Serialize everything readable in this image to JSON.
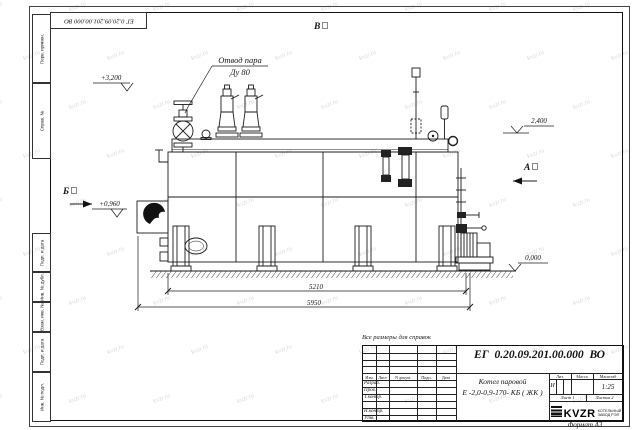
{
  "watermark": {
    "text": "kvzr.ru"
  },
  "stamps": {
    "top_designation": "ЕГ 0.20.09.201.00.000 ВО",
    "left_top": [
      "Перв. примен.",
      "Справ. №"
    ],
    "left_bottom": [
      "Подп. и дата",
      "Инв. № дубл.",
      "Взам. инв. №",
      "Подп. и дата",
      "Инв. № подл."
    ],
    "format_label": "Формат А3"
  },
  "annotations": {
    "note": "Все размеры для справок",
    "callout_line1": "Отвод пара",
    "callout_line2": "Ду 80",
    "elev_top": "+3,200",
    "elev_right": "2,400",
    "elev_burner": "+0,960",
    "elev_ground": "0,000",
    "view_b": "Б",
    "view_a": "А",
    "view_v": "В",
    "dim_inner": "5210",
    "dim_outer": "5950"
  },
  "title_block": {
    "designation": "ЕГ 0.20.09.201.00.000 ВО",
    "name_line1": "Котел паровой",
    "name_line2": "Е -2,0-0,9-170- КБ ( ЖК )",
    "cols": [
      "Изм.",
      "Лист",
      "N докум.",
      "Подп.",
      "Дата"
    ],
    "rows": [
      "Разраб.",
      "Пров.",
      "Т.контр.",
      "",
      "Н.контр.",
      "Утв."
    ],
    "lit_header": "Лит.",
    "lit_value": "И",
    "mass_header": "Масса",
    "scale_header": "Масштаб",
    "scale_value": "1:25",
    "sheet": "Лист 1",
    "sheets": "Листов 2",
    "logo": "KVZR",
    "org_line1": "КОТЕЛЬНЫЙ",
    "org_line2": "ЗАВОД РЭП"
  }
}
